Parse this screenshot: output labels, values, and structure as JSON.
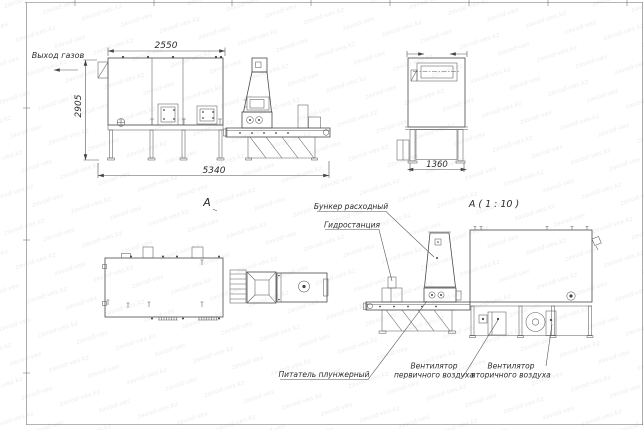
{
  "watermark": {
    "text": "zavod-ves.kz"
  },
  "drawing": {
    "front_view": {
      "gas_outlet_label": "Выход газов",
      "dim_top": "2550",
      "dim_height": "2905",
      "dim_length": "5340"
    },
    "end_view": {
      "dim_width": "1360"
    },
    "plan_view": {
      "label": "A"
    },
    "detail_view": {
      "label": "A ( 1 : 10 )",
      "callout_hopper": "Бункер расходный",
      "callout_hydro": "Гидростанция",
      "callout_feeder": "Питатель плунжерный",
      "callout_fan_primary_line1": "Вентилятор",
      "callout_fan_primary_line2": "первичного воздуха",
      "callout_fan_secondary_line1": "Вентилятор",
      "callout_fan_secondary_line2": "вторичного воздуха"
    }
  }
}
